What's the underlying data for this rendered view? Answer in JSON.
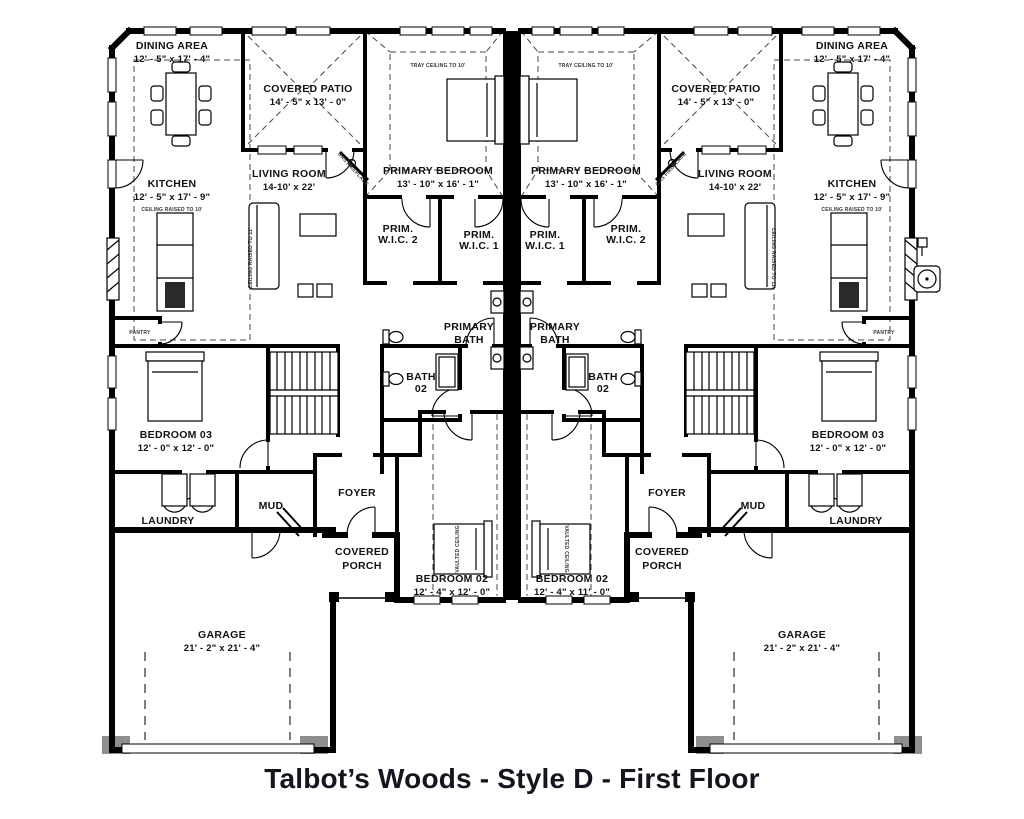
{
  "title": "Talbot’s Woods - Style D - First Floor",
  "left_unit": {
    "dining_area": {
      "name": "DINING AREA",
      "dims": "12' - 5\" x 17' - 4\""
    },
    "kitchen": {
      "name": "KITCHEN",
      "dims": "12' - 5\" x 17' - 9\"",
      "ceiling_note": "CEILING RAISED TO 10'"
    },
    "covered_patio": {
      "name": "COVERED PATIO",
      "dims": "14' - 5\" x 13' - 0\""
    },
    "living_room": {
      "name": "LIVING ROOM",
      "dims": "14-10' x 22'",
      "ceiling_note": "CEILING RAISED TO 11'",
      "fireplace_note": "GAS FIREPLACE"
    },
    "primary_bedroom": {
      "name": "PRIMARY BEDROOM",
      "dims": "13' - 10\" x 16' - 1\"",
      "ceiling_note": "TRAY CEILING TO 10'"
    },
    "prim_wic_1": {
      "line1": "PRIM.",
      "line2": "W.I.C. 1"
    },
    "prim_wic_2": {
      "line1": "PRIM.",
      "line2": "W.I.C. 2"
    },
    "primary_bath": {
      "line1": "PRIMARY",
      "line2": "BATH"
    },
    "bath_02": {
      "line1": "BATH",
      "line2": "02"
    },
    "bedroom_03": {
      "name": "BEDROOM 03",
      "dims": "12' - 0\" x 12' - 0\""
    },
    "pantry": {
      "name": "PANTRY"
    },
    "laundry": {
      "name": "LAUNDRY"
    },
    "mud": {
      "name": "MUD"
    },
    "foyer": {
      "name": "FOYER"
    },
    "covered_porch": {
      "line1": "COVERED",
      "line2": "PORCH"
    },
    "bedroom_02": {
      "name": "BEDROOM 02",
      "dims": "12' - 4\" x 12' - 0\"",
      "ceiling_note": "VAULTED CEILING"
    },
    "garage": {
      "name": "GARAGE",
      "dims": "21' - 2\" x 21' - 4\""
    }
  },
  "right_unit": {
    "dining_area": {
      "name": "DINING AREA",
      "dims": "12' - 5\" x 17' - 4\""
    },
    "kitchen": {
      "name": "KITCHEN",
      "dims": "12' - 5\" x 17' - 9\"",
      "ceiling_note": "CEILING RAISED TO 10'"
    },
    "covered_patio": {
      "name": "COVERED PATIO",
      "dims": "14' - 5\" x 13' - 0\""
    },
    "living_room": {
      "name": "LIVING ROOM",
      "dims": "14-10' x 22'",
      "ceiling_note": "CEILING RAISED TO 11'",
      "fireplace_note": "GAS FIREPLACE"
    },
    "primary_bedroom": {
      "name": "PRIMARY BEDROOM",
      "dims": "13' - 10\" x 16' - 1\"",
      "ceiling_note": "TRAY CEILING TO 10'"
    },
    "prim_wic_1": {
      "line1": "PRIM.",
      "line2": "W.I.C. 1"
    },
    "prim_wic_2": {
      "line1": "PRIM.",
      "line2": "W.I.C. 2"
    },
    "primary_bath": {
      "line1": "PRIMARY",
      "line2": "BATH"
    },
    "bath_02": {
      "line1": "BATH",
      "line2": "02"
    },
    "bedroom_03": {
      "name": "BEDROOM 03",
      "dims": "12' - 0\" x 12' - 0\""
    },
    "pantry": {
      "name": "PANTRY"
    },
    "laundry": {
      "name": "LAUNDRY"
    },
    "mud": {
      "name": "MUD"
    },
    "foyer": {
      "name": "FOYER"
    },
    "covered_porch": {
      "line1": "COVERED",
      "line2": "PORCH"
    },
    "bedroom_02": {
      "name": "BEDROOM 02",
      "dims": "12' - 4\" x 11' - 0\"",
      "ceiling_note": "VAULTED CEILING"
    },
    "garage": {
      "name": "GARAGE",
      "dims": "21' - 2\" x 21' - 4\""
    }
  }
}
